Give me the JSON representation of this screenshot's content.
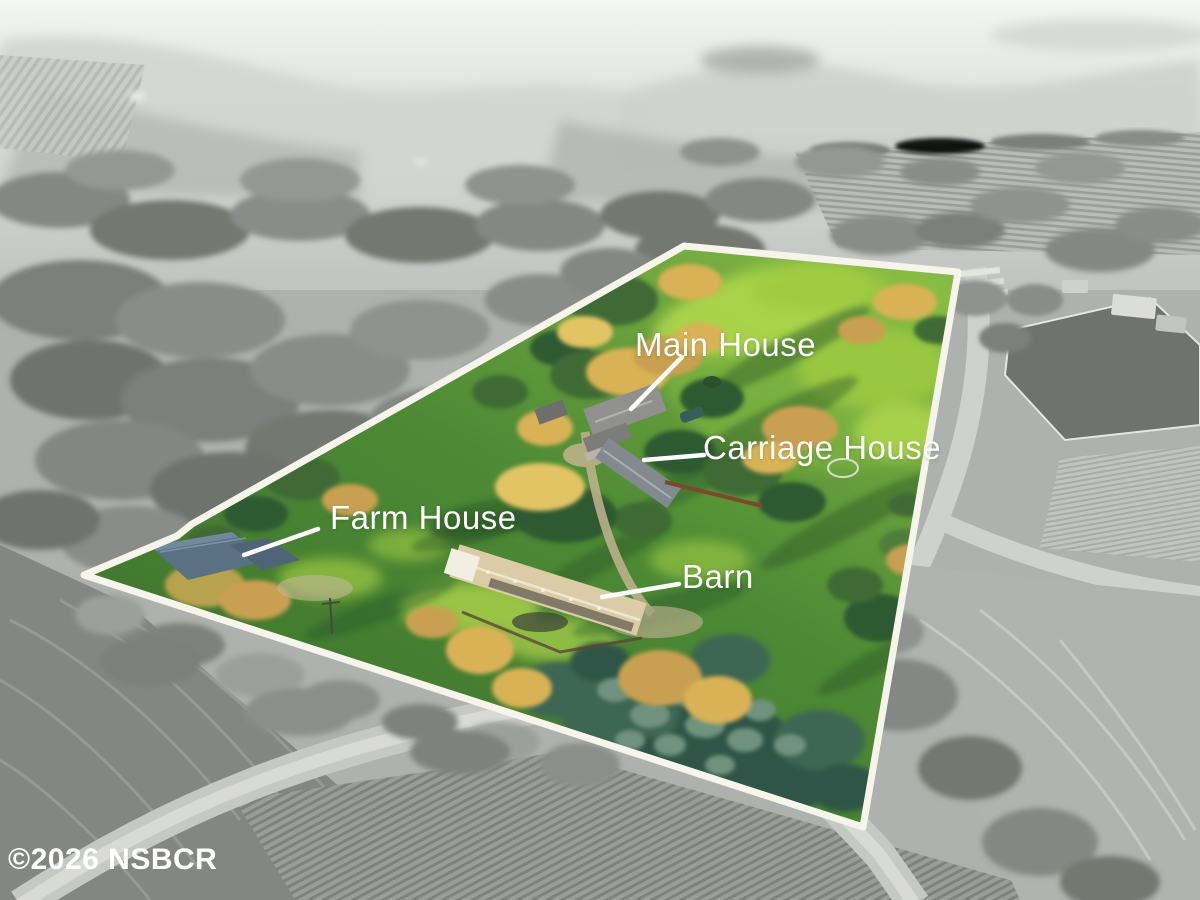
{
  "photo": {
    "watermark": "©2026 NSBCR"
  },
  "annotations": {
    "main_house": {
      "label": "Main House"
    },
    "carriage_house": {
      "label": "Carriage House"
    },
    "farm_house": {
      "label": "Farm House"
    },
    "barn": {
      "label": "Barn"
    }
  },
  "colors": {
    "boundary_line": "#f7f4ec",
    "label_text": "#ffffff",
    "grass_green": "#4c8836",
    "highlight_green": "#a5cf48",
    "autumn_tree": "#d9b257",
    "monochrome_field": "#b5b8b4"
  }
}
